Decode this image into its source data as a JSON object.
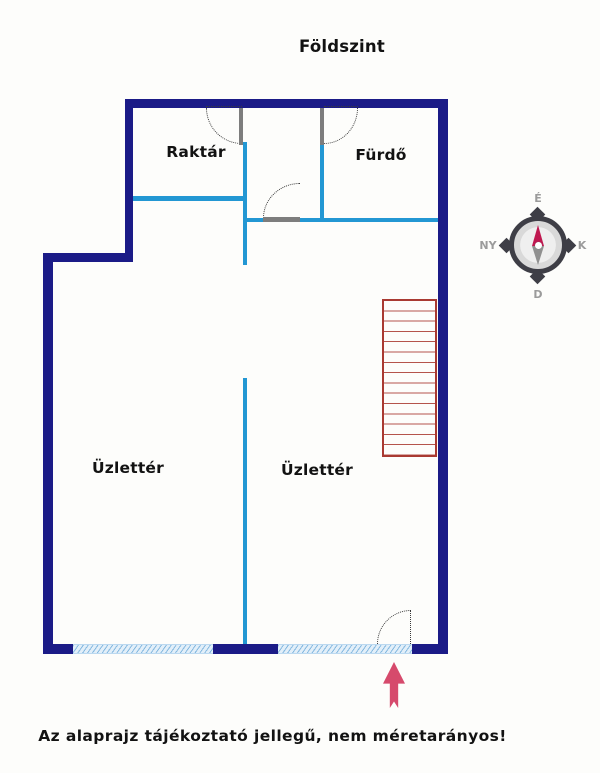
{
  "title": "Földszint",
  "rooms": {
    "raktar": "Raktár",
    "furdo": "Fürdő",
    "uzletter_left": "Üzlettér",
    "uzletter_right": "Üzlettér"
  },
  "compass": {
    "n": "É",
    "e": "K",
    "s": "D",
    "w": "NY"
  },
  "stairs": {
    "treads": 15
  },
  "footnote": "Az alaprajz tájékoztató jellegű, nem méretarányos!",
  "colors": {
    "outer_wall": "#1b1b87",
    "inner_wall": "#2397d3",
    "stairs": "#a93a32",
    "arrow": "#d64a6c",
    "needle_north": "#bf1850",
    "window": "#bcd9f0"
  }
}
